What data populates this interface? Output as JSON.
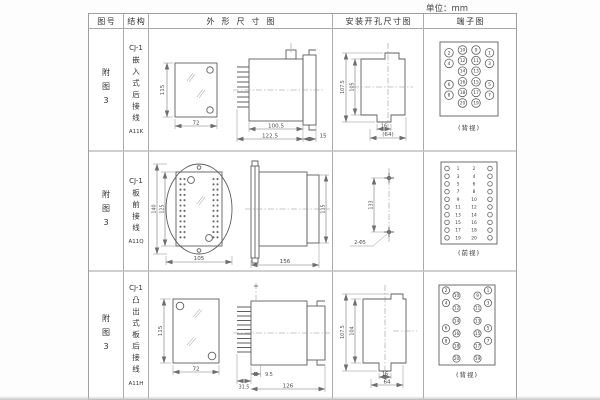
{
  "unit_label": "单位：mm",
  "table": {
    "headers": {
      "figure": "图号",
      "structure": "结构",
      "outline": "外形尺寸图",
      "mounting": "安装开孔尺寸图",
      "terminal": "端子图"
    },
    "rows": [
      {
        "figure_no": "附图3",
        "structure": {
          "series": "CJ-1",
          "name": "嵌入式后接线",
          "code": "A11K"
        },
        "outline_dims": {
          "height": "115",
          "width": "72",
          "depth": "100.5",
          "total_depth": "122.5",
          "flange": "15"
        },
        "mounting_dims": {
          "outer_height": "107.5",
          "cutout_height": "105",
          "slot_width": "16",
          "span": "(64)"
        },
        "terminal": {
          "view": "(背视)",
          "type": "grid",
          "cells": [
            [
              "2",
              "10",
              "9",
              "1"
            ],
            [
              "4",
              "12",
              "11",
              "3"
            ],
            [
              "",
              "14",
              "13",
              ""
            ],
            [
              "6",
              "16",
              "15",
              "5"
            ],
            [
              "8",
              "18",
              "17",
              "7"
            ],
            [
              "",
              "20",
              "19",
              ""
            ]
          ]
        }
      },
      {
        "figure_no": "附图3",
        "structure": {
          "series": "CJ-1",
          "name": "板前接线",
          "code": "A11Q"
        },
        "outline_dims": {
          "outer_height": "140",
          "inner_height": "125",
          "width": "105",
          "body_height": "115",
          "depth": "156"
        },
        "mounting_dims": {
          "hole_span": "133",
          "holes": "2-Φ5"
        },
        "terminal": {
          "view": "(前视)",
          "type": "pairs",
          "cells": [
            [
              "1",
              "2"
            ],
            [
              "3",
              "4"
            ],
            [
              "5",
              "6"
            ],
            [
              "7",
              "8"
            ],
            [
              "9",
              "10"
            ],
            [
              "11",
              "12"
            ],
            [
              "13",
              "14"
            ],
            [
              "15",
              "16"
            ],
            [
              "17",
              "18"
            ],
            [
              "19",
              "20"
            ]
          ]
        }
      },
      {
        "figure_no": "附图3",
        "structure": {
          "series": "CJ-1",
          "name": "凸出式板后接线",
          "code": "A11H"
        },
        "outline_dims": {
          "height": "115",
          "width": "72",
          "pin_depth": "31.5",
          "offset": "9.5",
          "depth": "126"
        },
        "mounting_dims": {
          "outer_height": "107.5",
          "cutout_height": "104",
          "slot_width": "16",
          "span": "64"
        },
        "terminal": {
          "view": "(背视)",
          "type": "stagger",
          "cells": [
            [
              "2",
              "10",
              "9",
              "1"
            ],
            [
              "4",
              "12",
              "11",
              "3"
            ],
            [
              "",
              "14",
              "13",
              ""
            ],
            [
              "6",
              "16",
              "15",
              "5"
            ],
            [
              "8",
              "18",
              "17",
              "7"
            ],
            [
              "",
              "20",
              "19",
              ""
            ]
          ]
        }
      }
    ]
  }
}
